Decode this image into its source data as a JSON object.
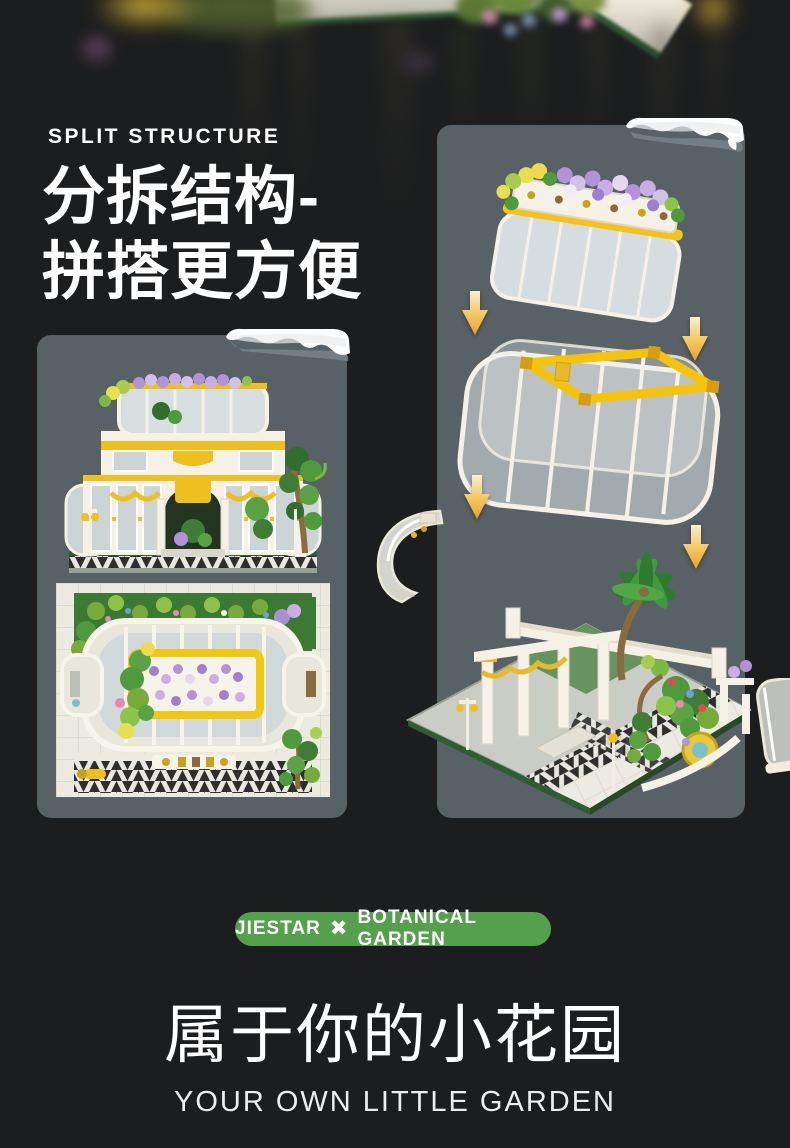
{
  "theme": {
    "background": "#1c1d1e",
    "card_background": "#586165",
    "accent_gold": "#f2c31d",
    "badge_green": "#55a04c",
    "text_color": "#ffffff"
  },
  "split_section": {
    "eyebrow": "SPLIT STRUCTURE",
    "title_line1": "分拆结构-",
    "title_line2": "拼搭更方便"
  },
  "badge": {
    "brand": "JIESTAR",
    "separator_icon": "✖",
    "product": "BOTANICAL GARDEN"
  },
  "footer": {
    "title_cn": "属于你的小花园",
    "subtitle_en": "YOUR OWN LITTLE GARDEN"
  }
}
